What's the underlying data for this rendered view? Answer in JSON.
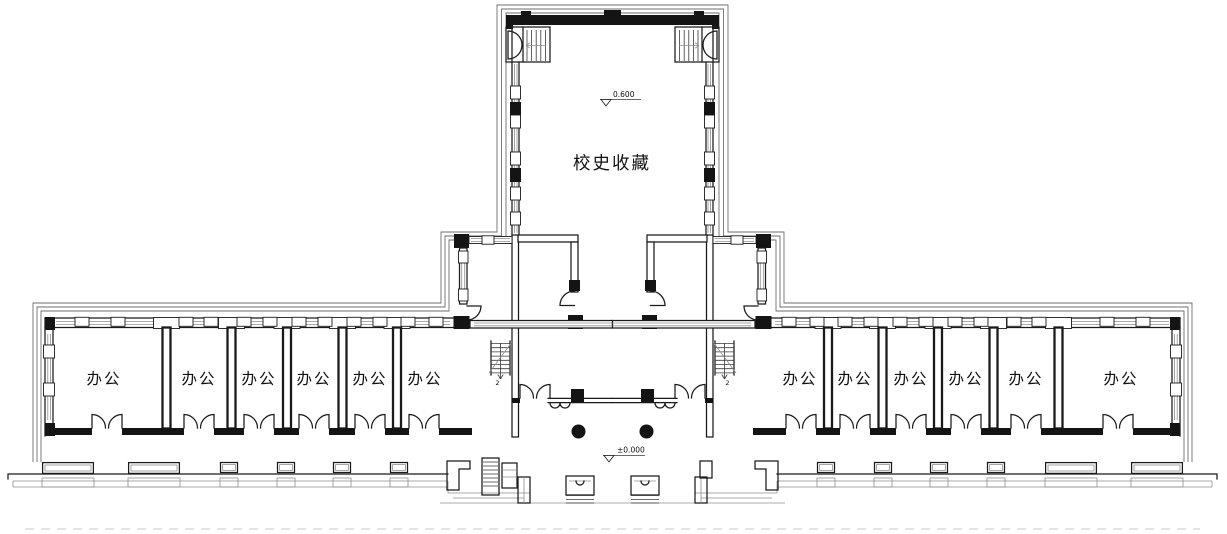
{
  "plan": {
    "central_hall": {
      "label": "校史收藏",
      "level": "0.600"
    },
    "entrance": {
      "level": "±0.000"
    },
    "left_wing_rooms": [
      "办公",
      "办公",
      "办公",
      "办公",
      "办公",
      "办公"
    ],
    "right_wing_rooms": [
      "办公",
      "办公",
      "办公",
      "办公",
      "办公",
      "办公"
    ],
    "stairs": {
      "left_mark": "2",
      "right_mark": "2"
    }
  },
  "colors": {
    "line": "#1a1a1a",
    "thin_line": "#8f8f8f",
    "background": "#ffffff"
  }
}
